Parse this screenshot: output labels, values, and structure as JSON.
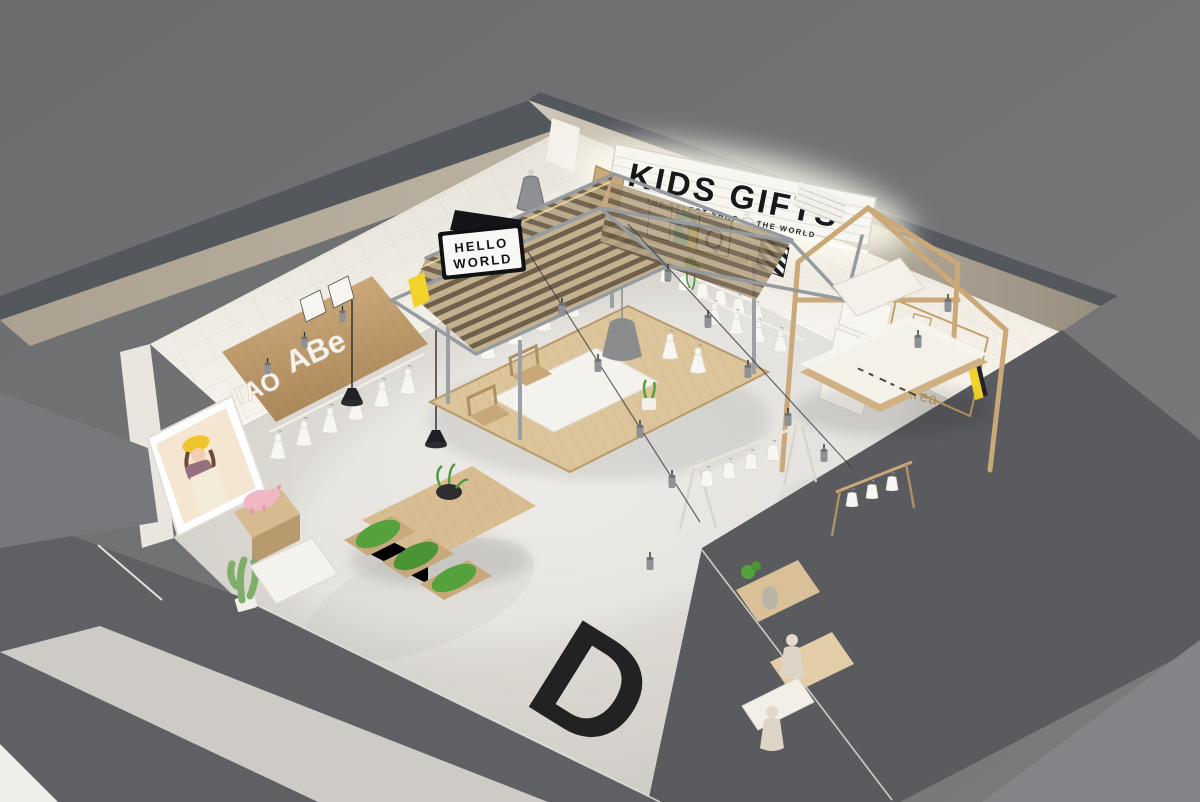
{
  "meta": {
    "description": "Aerial cutaway 3D render of a kids' gift select-shop interior"
  },
  "signs": {
    "marquee": {
      "title": "KIDS GIFTS",
      "subtitle": "THE SELECT SHOP IN THE WORLD"
    },
    "hello_lightbox": {
      "line1": "HELLO",
      "line2": "WORLD"
    },
    "wall_letters": {
      "left": "TAO",
      "right": "ABe"
    },
    "poster_letter": "Q",
    "zone_wall_text": {
      "line1": "Coffee",
      "line2": "Food",
      "line3": "Rest Area"
    },
    "floor_letter": "D"
  },
  "palette": {
    "background": "#6f7072",
    "outside_shadow": "#5d5f63",
    "sidewalk": "#848588",
    "exterior_wall": "#b3aa9b",
    "wall_tile": "#eeebe5",
    "floor": "#d3d0ca",
    "wood_light": "#d9bf97",
    "wood_mid": "#c3a477",
    "steel": "#94999e",
    "slat_dark": "#6f5f4b",
    "signboard": "#f7f6f1",
    "text_black": "#17181a",
    "zone_text_gold": "#c39a5e",
    "accent_yellow": "#f2d32c",
    "accent_teal": "#27b3a2",
    "accent_pink": "#f0b8c4",
    "plant_green": "#55a23d"
  },
  "objects": [
    "marquee-sign",
    "hello-world-lightbox",
    "slatted-canopy",
    "center-platform-table",
    "clothing-racks",
    "dress-form-mannequins",
    "wall-letter-display",
    "planter-table",
    "cashier-counter",
    "coffee-rest-area-frame",
    "girl-photo-lightbox",
    "pink-pig-figure",
    "cactus-plant",
    "floor-letter-d",
    "window-display-mannequins",
    "track-spotlights",
    "black-pendant-lamps"
  ]
}
